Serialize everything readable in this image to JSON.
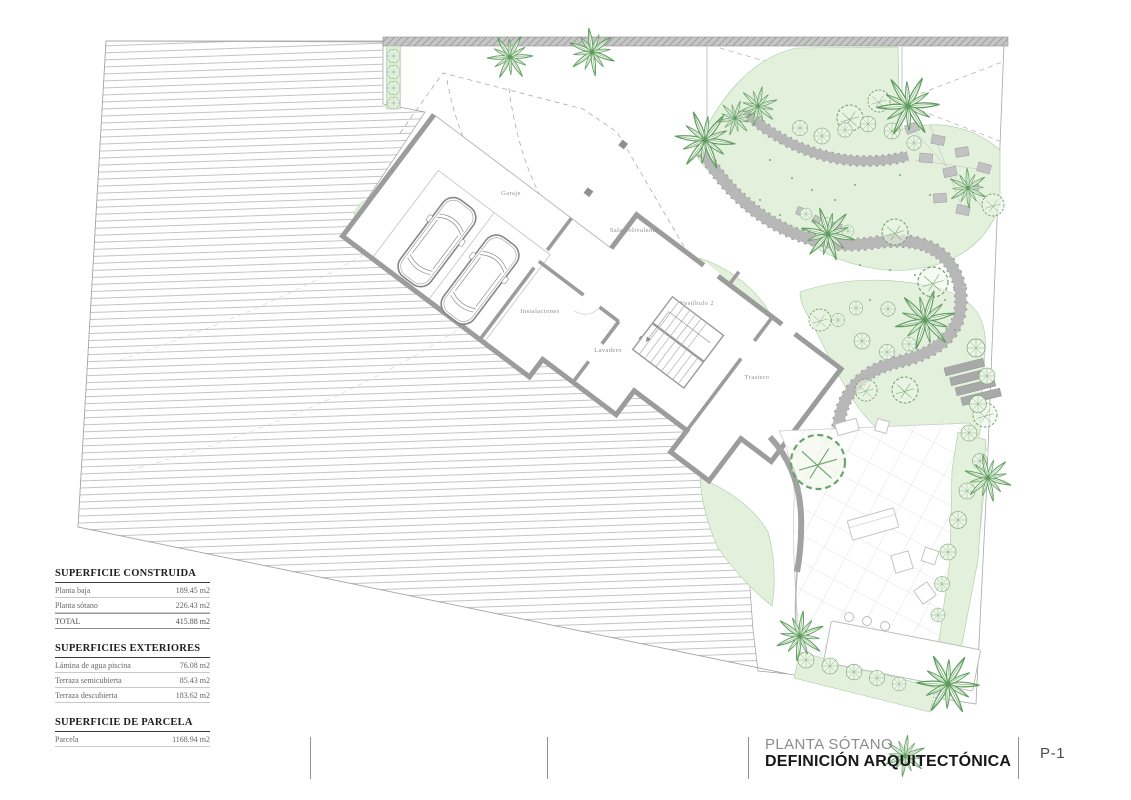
{
  "sheet": {
    "phase": "PLANTA SÓTANO",
    "title": "DEFINICIÓN ARQUITECTÓNICA",
    "number": "P-1"
  },
  "rooms": [
    {
      "label": "Garaje"
    },
    {
      "label": "Sala polivalente"
    },
    {
      "label": "Instalaciones"
    },
    {
      "label": "Vestíbulo 2"
    },
    {
      "label": "Lavadero"
    },
    {
      "label": "Trastero"
    }
  ],
  "tables": [
    {
      "title": "SUPERFICIE CONSTRUIDA",
      "rows": [
        {
          "label": "Planta baja",
          "value": "189.45 m2"
        },
        {
          "label": "Planta sótano",
          "value": "226.43 m2"
        },
        {
          "label": "TOTAL",
          "value": "415.88 m2"
        }
      ]
    },
    {
      "title": "SUPERFICIES EXTERIORES",
      "rows": [
        {
          "label": "Lámina de agua piscina",
          "value": "76.08 m2"
        },
        {
          "label": "Terraza semicubierta",
          "value": "85.43 m2"
        },
        {
          "label": "Terraza descubierta",
          "value": "183.62 m2"
        }
      ]
    },
    {
      "title": "SUPERFICIE DE PARCELA",
      "rows": [
        {
          "label": "Parcela",
          "value": "1168.94 m2"
        }
      ]
    }
  ],
  "colors": {
    "wall": "#9c9c9c",
    "green_fill": "#e3f0dc",
    "green_stroke": "#6aa369",
    "hatch_line": "#9a9a9a",
    "path_gray": "#b7b7b7"
  }
}
